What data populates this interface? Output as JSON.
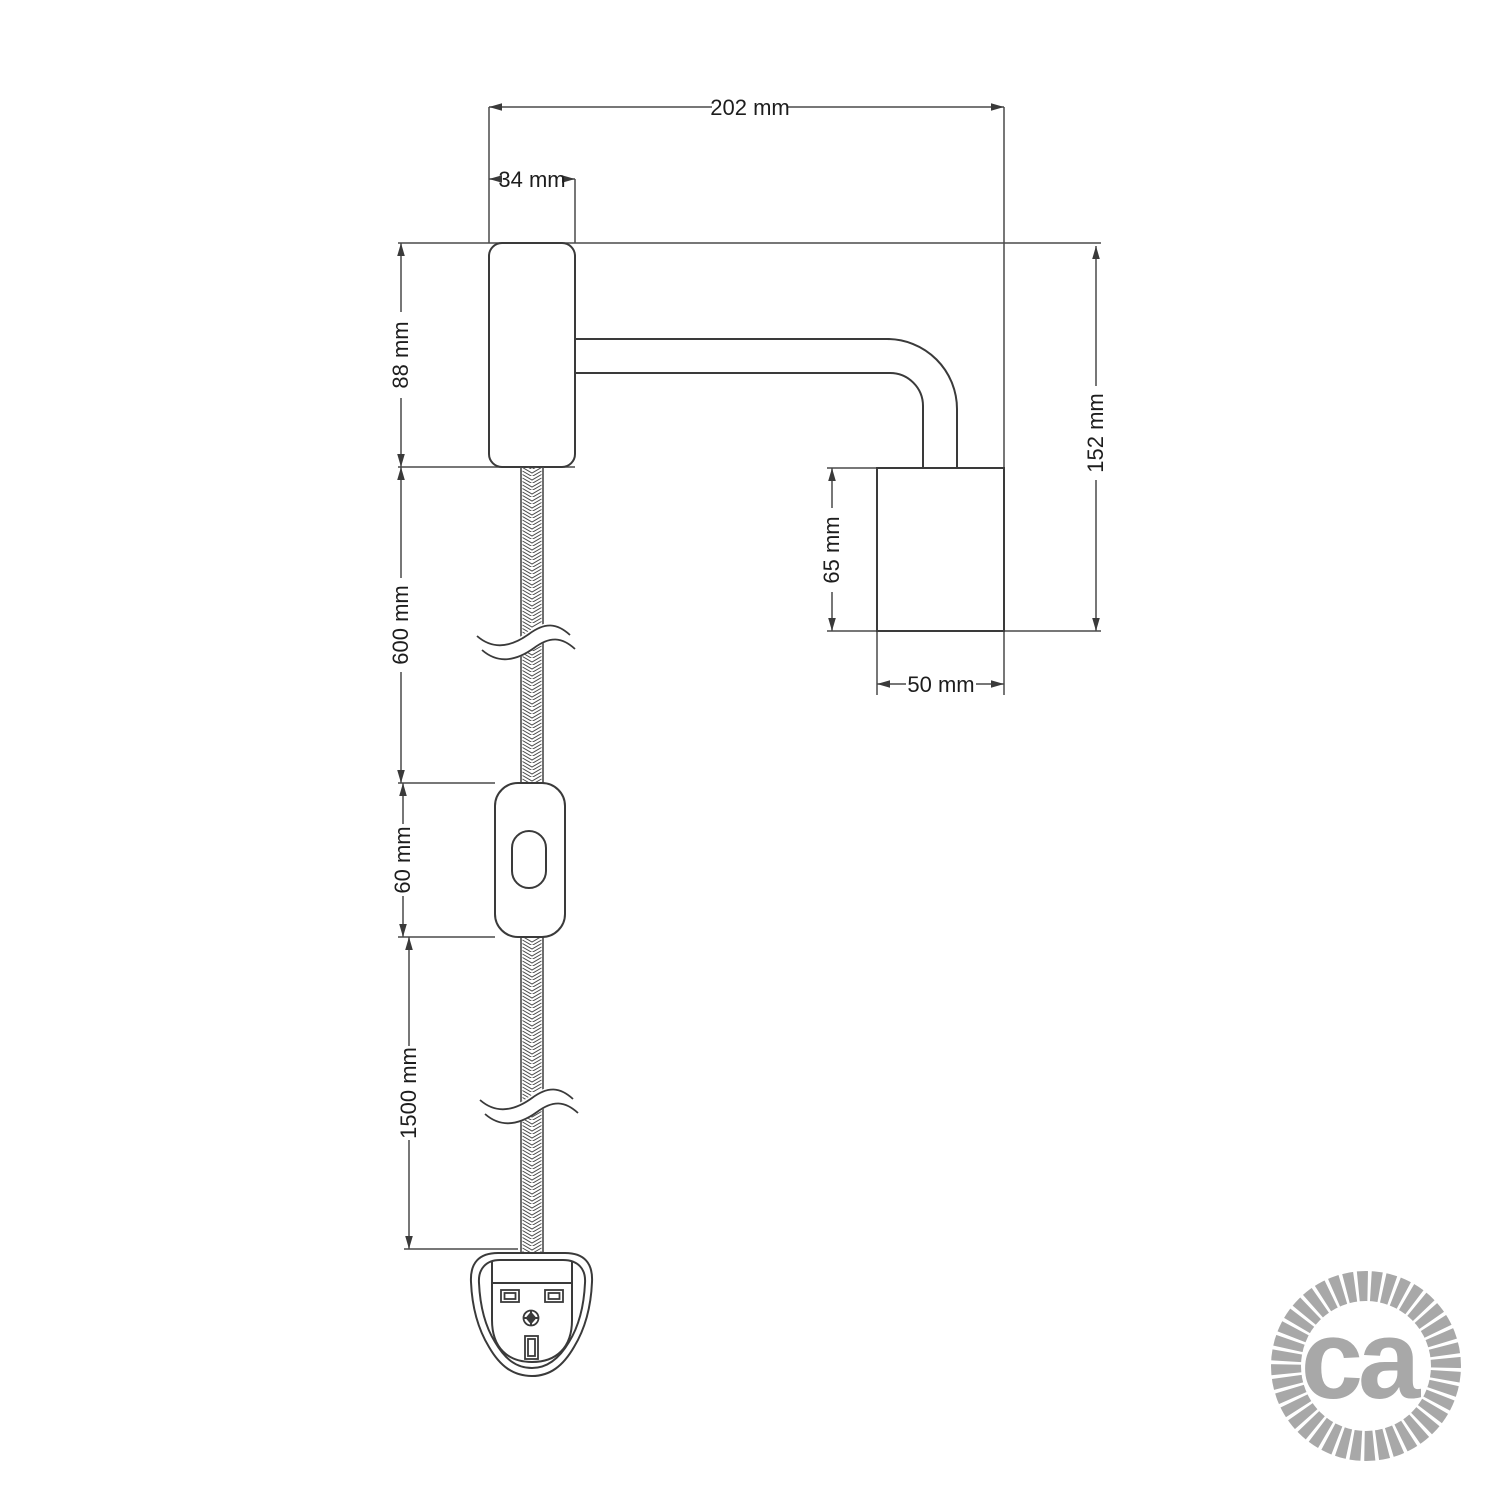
{
  "drawing": {
    "type": "technical-dimension-drawing",
    "subject": "wall spotlight with braided cable, inline switch and plug",
    "dimensions": {
      "total_width": {
        "label": "202 mm"
      },
      "wall_base_width": {
        "label": "34 mm"
      },
      "wall_base_height": {
        "label": "88 mm"
      },
      "cable_upper_length": {
        "label": "600 mm"
      },
      "switch_length": {
        "label": "60 mm"
      },
      "cable_lower_length": {
        "label": "1500 mm"
      },
      "total_height": {
        "label": "152 mm"
      },
      "spotlight_height": {
        "label": "65 mm"
      },
      "spotlight_width": {
        "label": "50 mm"
      }
    },
    "colors": {
      "outline": "#3a3a3a",
      "dimension_lines": "#4a4a4a",
      "label_text": "#1d1d1d",
      "logo_gray": "#a8a8a8",
      "background": "#ffffff"
    }
  },
  "logo": {
    "text": "ca"
  }
}
